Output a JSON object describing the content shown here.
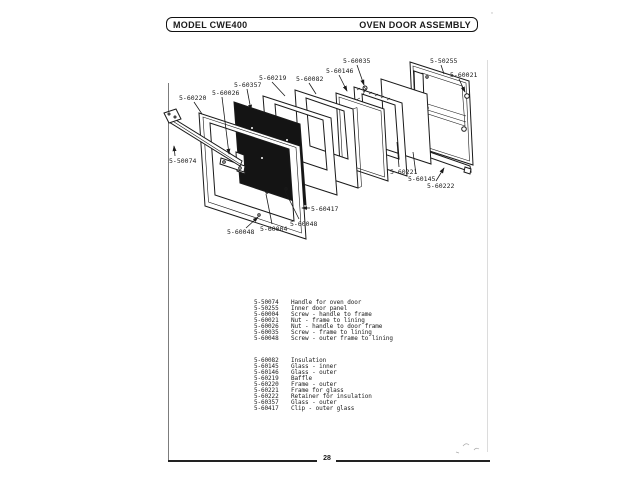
{
  "header": {
    "model": "MODEL CWE400",
    "title": "OVEN DOOR ASSEMBLY"
  },
  "footer": {
    "page_number": "28"
  },
  "diagram": {
    "colors": {
      "ink": "#1a1a1a",
      "paper": "#ffffff",
      "glass_panel_fill": "#141414"
    },
    "labels": [
      {
        "text": "5-60220",
        "x": 179,
        "y": 100,
        "leader": [
          194,
          102,
          202,
          114
        ],
        "arrow": false
      },
      {
        "text": "5-60026",
        "x": 212,
        "y": 95,
        "leader": [
          222,
          97,
          229,
          154
        ],
        "arrow": true
      },
      {
        "text": "5-60357",
        "x": 234,
        "y": 87,
        "leader": [
          247,
          89,
          251,
          110
        ],
        "arrow": true
      },
      {
        "text": "5-60219",
        "x": 259,
        "y": 80,
        "leader": [
          272,
          82,
          285,
          96
        ],
        "arrow": false
      },
      {
        "text": "5-60082",
        "x": 296,
        "y": 81,
        "leader": [
          309,
          83,
          316,
          94
        ],
        "arrow": false
      },
      {
        "text": "5-60146",
        "x": 326,
        "y": 73,
        "leader": [
          339,
          75,
          347,
          91
        ],
        "arrow": true
      },
      {
        "text": "5-60035",
        "x": 343,
        "y": 63,
        "leader": [
          357,
          65,
          364,
          85
        ],
        "arrow": true
      },
      {
        "text": "5-50255",
        "x": 430,
        "y": 63,
        "leader": [
          441,
          65,
          444,
          74
        ],
        "arrow": false
      },
      {
        "text": "5-60021",
        "x": 450,
        "y": 77,
        "leader": [
          459,
          79,
          465,
          92
        ],
        "arrow": true
      },
      {
        "text": "5-50074",
        "x": 169,
        "y": 163,
        "leader": [
          175,
          156,
          174,
          146
        ],
        "arrow": true
      },
      {
        "text": "5-60221",
        "x": 390,
        "y": 174,
        "leader": [
          399,
          167,
          397,
          142
        ],
        "arrow": false
      },
      {
        "text": "5-60145",
        "x": 408,
        "y": 181,
        "leader": [
          416,
          174,
          413,
          152
        ],
        "arrow": false
      },
      {
        "text": "5-60222",
        "x": 427,
        "y": 188,
        "leader": [
          436,
          181,
          444,
          168
        ],
        "arrow": true
      },
      {
        "text": "5-60417",
        "x": 311,
        "y": 211,
        "leader": [
          310,
          208,
          302,
          208
        ],
        "arrow": true
      },
      {
        "text": "5-60048",
        "x": 227,
        "y": 234,
        "leader": [
          246,
          228,
          258,
          217
        ],
        "arrow": true
      },
      {
        "text": "5-60004",
        "x": 260,
        "y": 231,
        "leader": [
          272,
          224,
          266,
          194
        ],
        "arrow": false
      },
      {
        "text": "5-60048",
        "x": 290,
        "y": 226,
        "leader": [
          299,
          219,
          285,
          191
        ],
        "arrow": false
      }
    ]
  },
  "parts_list": {
    "groups": [
      {
        "items": [
          {
            "number": "5-50074",
            "description": "Handle for oven door"
          },
          {
            "number": "5-50255",
            "description": "Inner door panel"
          },
          {
            "number": "5-60004",
            "description": "Screw - handle to frame"
          },
          {
            "number": "5-60021",
            "description": "Nut - frame to lining"
          },
          {
            "number": "5-60026",
            "description": "Nut - handle to door frame"
          },
          {
            "number": "5-60035",
            "description": "Screw - frame to lining"
          },
          {
            "number": "5-60048",
            "description": "Screw - outer frame to lining"
          }
        ]
      },
      {
        "items": [
          {
            "number": "5-60082",
            "description": "Insulation"
          },
          {
            "number": "5-60145",
            "description": "Glass - inner"
          },
          {
            "number": "5-60146",
            "description": "Glass - outer"
          },
          {
            "number": "5-60219",
            "description": "Baffle"
          },
          {
            "number": "5-60220",
            "description": "Frame - outer"
          },
          {
            "number": "5-60221",
            "description": "Frame for glass"
          },
          {
            "number": "5-60222",
            "description": "Retainer for insulation"
          },
          {
            "number": "5-60357",
            "description": "Glass - outer"
          },
          {
            "number": "5-60417",
            "description": "Clip - outer glass"
          }
        ]
      }
    ]
  }
}
